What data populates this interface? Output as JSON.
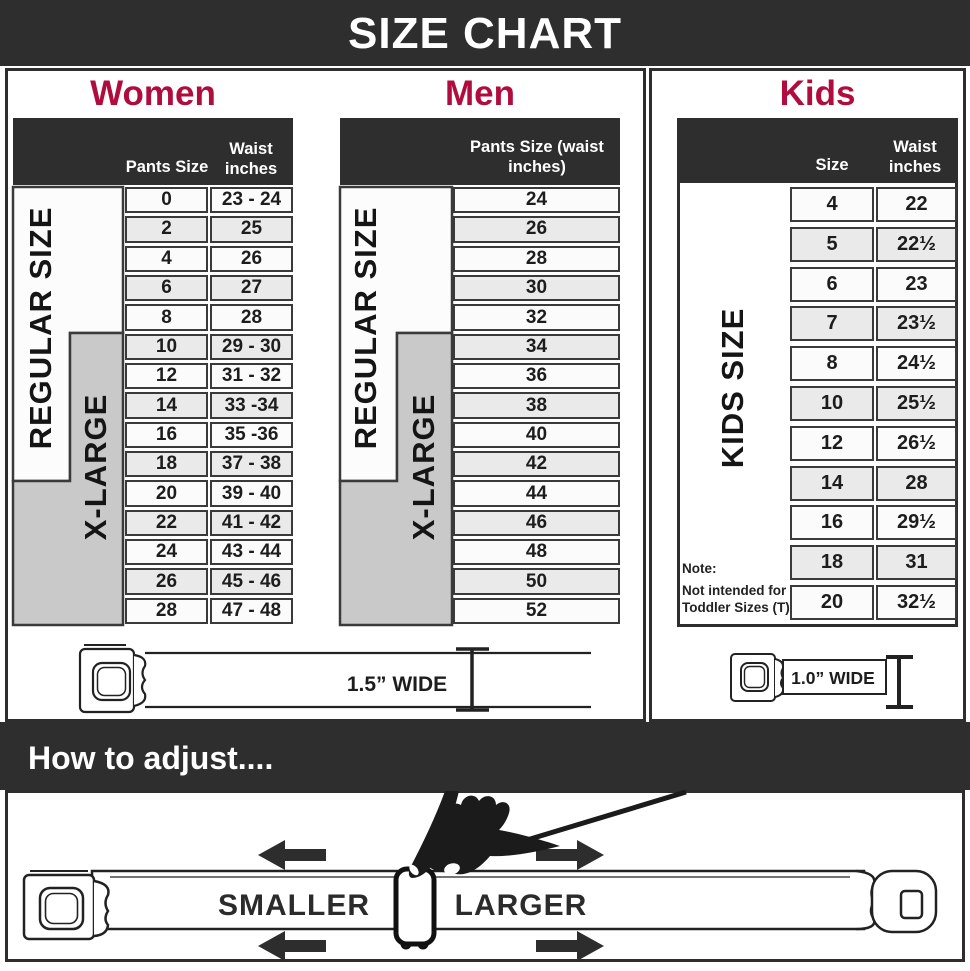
{
  "title": "SIZE CHART",
  "colors": {
    "accent": "#b00d3e",
    "header_bar": "#2e2e2e",
    "xlarge_gray": "#c9c9c9"
  },
  "women": {
    "heading": "Women",
    "col1": "Pants Size",
    "col2": "Waist inches",
    "regular": "REGULAR SIZE",
    "xlarge": "X-LARGE",
    "rows": [
      {
        "size": "0",
        "waist": "23 - 24"
      },
      {
        "size": "2",
        "waist": "25"
      },
      {
        "size": "4",
        "waist": "26"
      },
      {
        "size": "6",
        "waist": "27"
      },
      {
        "size": "8",
        "waist": "28"
      },
      {
        "size": "10",
        "waist": "29 - 30"
      },
      {
        "size": "12",
        "waist": "31 - 32"
      },
      {
        "size": "14",
        "waist": "33 -34"
      },
      {
        "size": "16",
        "waist": "35 -36"
      },
      {
        "size": "18",
        "waist": "37 - 38"
      },
      {
        "size": "20",
        "waist": "39 - 40"
      },
      {
        "size": "22",
        "waist": "41 - 42"
      },
      {
        "size": "24",
        "waist": "43 - 44"
      },
      {
        "size": "26",
        "waist": "45 - 46"
      },
      {
        "size": "28",
        "waist": "47 - 48"
      }
    ],
    "belt_label": "1.5” WIDE"
  },
  "men": {
    "heading": "Men",
    "col": "Pants Size (waist inches)",
    "regular": "REGULAR SIZE",
    "xlarge": "X-LARGE",
    "sizes": [
      "24",
      "26",
      "28",
      "30",
      "32",
      "34",
      "36",
      "38",
      "40",
      "42",
      "44",
      "46",
      "48",
      "50",
      "52"
    ]
  },
  "kids": {
    "heading": "Kids",
    "col1": "Size",
    "col2": "Waist inches",
    "label": "KIDS SIZE",
    "note1": "Note:",
    "note2": "Not intended for",
    "note3": "Toddler Sizes (T)",
    "rows": [
      {
        "size": "4",
        "waist": "22"
      },
      {
        "size": "5",
        "waist": "22½"
      },
      {
        "size": "6",
        "waist": "23"
      },
      {
        "size": "7",
        "waist": "23½"
      },
      {
        "size": "8",
        "waist": "24½"
      },
      {
        "size": "10",
        "waist": "25½"
      },
      {
        "size": "12",
        "waist": "26½"
      },
      {
        "size": "14",
        "waist": "28"
      },
      {
        "size": "16",
        "waist": "29½"
      },
      {
        "size": "18",
        "waist": "31"
      },
      {
        "size": "20",
        "waist": "32½"
      }
    ],
    "belt_label": "1.0” WIDE"
  },
  "adjust": {
    "heading": "How to adjust....",
    "smaller": "SMALLER",
    "larger": "LARGER"
  }
}
